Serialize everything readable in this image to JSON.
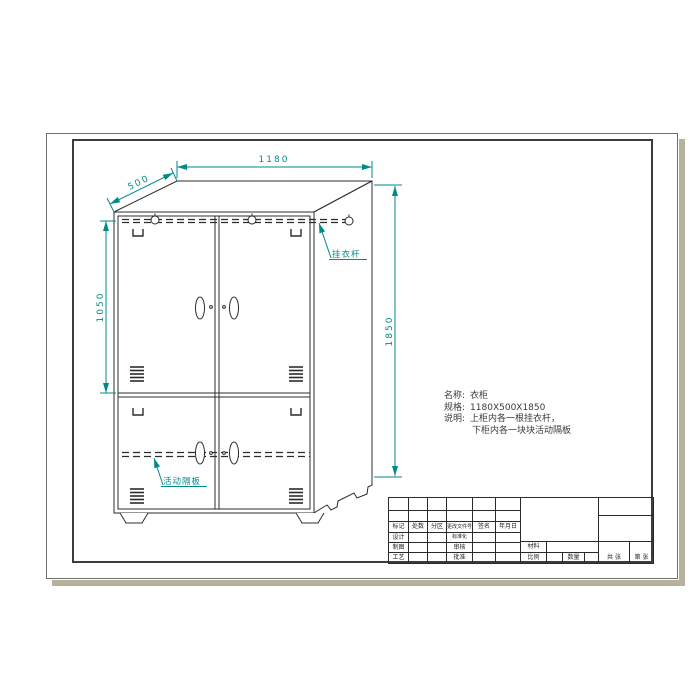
{
  "drawing": {
    "dimensions": {
      "width": "1180",
      "depth": "500",
      "upper_height": "1050",
      "height": "1850"
    },
    "callouts": {
      "hanging_rod": "挂衣杆",
      "movable_shelf": "活动隔板"
    }
  },
  "notes": {
    "name_label": "名称:",
    "name_value": "衣柜",
    "spec_label": "规格:",
    "spec_value": "1180X500X1850",
    "desc_label": "说明:",
    "desc_line1": "上柜内各一根挂衣杆，",
    "desc_line2": "下柜内各一块块活动隔板"
  },
  "title_block": {
    "mark": "标记",
    "count": "处数",
    "zone": "分区",
    "change_doc": "更改文件号",
    "signature": "签名",
    "date": "年月日",
    "design": "设计",
    "standardization": "标准化",
    "draft": "制图",
    "review": "审核",
    "material": "材料",
    "process": "工艺",
    "approve": "批准",
    "scale": "比例",
    "quantity": "数量",
    "sheets_total": "共 张",
    "sheet_no": "第 张"
  },
  "colors": {
    "accent": "#008b8b",
    "line": "#2c2c2c",
    "shadow": "#b7b19c"
  }
}
